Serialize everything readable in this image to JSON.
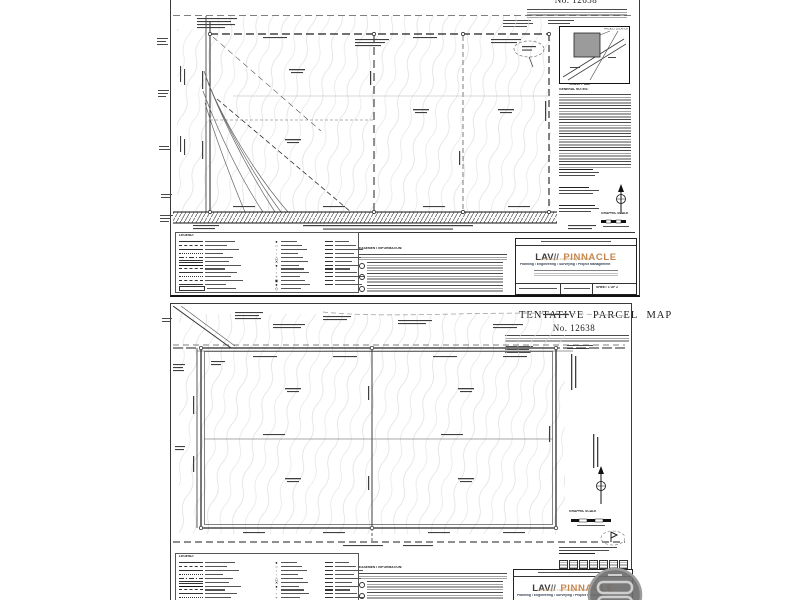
{
  "colors": {
    "paper": "#ffffff",
    "ink": "#222222",
    "contour_gray": "#dcdcdc",
    "brand_orange": "#c8854b",
    "brand_gray": "#3d3d3d",
    "brand_subtitle_tan": "#c9a678",
    "tagline_dark": "#2f3b4e",
    "watermark_gray": "#6e6e6e",
    "vicinity_parcel_fill": "#9b9b9b"
  },
  "labels": {
    "legend": "LEGEND:",
    "easement": "EASEMENT INFORMATION:",
    "general_notes": "GENERAL NOTES:",
    "vicinity_caption": "VICINITY MAP",
    "graphic_scale": "GRAPHIC SCALE",
    "project_location": "PROJECT LOCATION"
  },
  "brand": {
    "left": "LAV",
    "slashes": "//",
    "right": "PINNACLE",
    "subtitle": "Consulting & Engineering Services",
    "tagline": "Planning • Engineering • Surveying • Project Management"
  },
  "sheet1": {
    "number": "No. 12638",
    "sheet_label": "SHEET 1 OF 2"
  },
  "sheet2": {
    "title": "TENTATIVE PARCEL MAP",
    "number": "No. 12638",
    "sheet_label": "SHEET 2 OF 2"
  },
  "legend": {
    "line_styles": [
      "solid",
      "dashed",
      "solid",
      "dotted",
      "dashdot",
      "double",
      "bold",
      "dashed",
      "solid",
      "dotted",
      "dashed",
      "solid",
      "boxed"
    ],
    "symbols": [
      "●",
      "○",
      "▫",
      "◦",
      "△",
      "✕",
      "●",
      "◦",
      "▫",
      "+",
      "◉",
      "●",
      "◇"
    ],
    "abbrev_rows": 12,
    "label_widths": [
      30,
      22,
      34,
      18,
      28,
      24,
      36,
      20,
      32,
      26,
      38,
      21,
      29
    ]
  }
}
